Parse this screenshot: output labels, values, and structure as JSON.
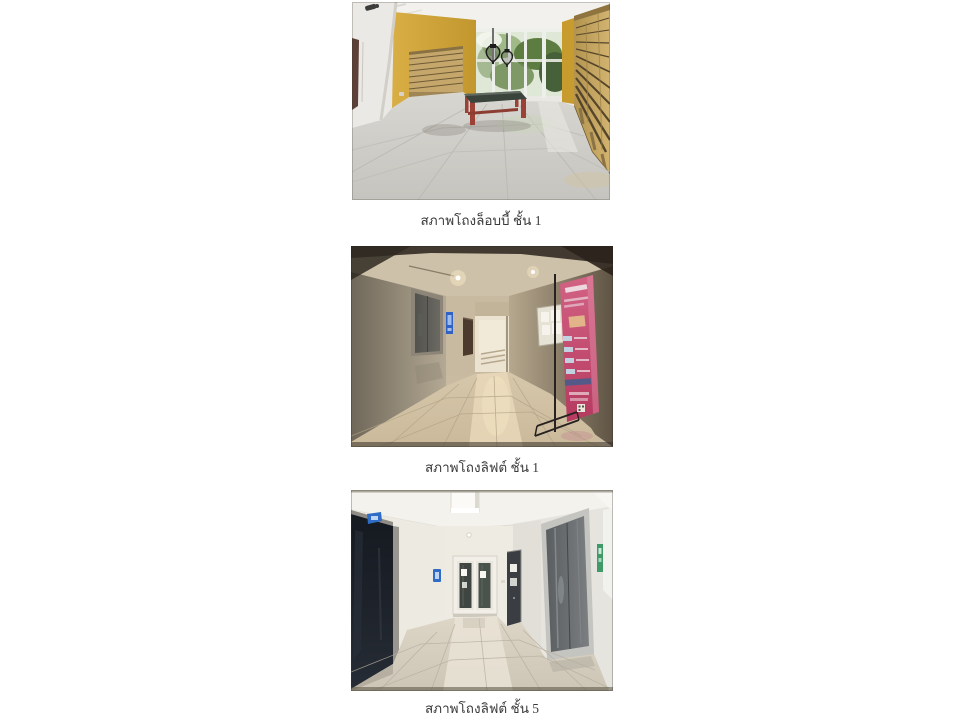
{
  "document": {
    "background_color": "#ffffff",
    "caption_color": "#3a3a3a"
  },
  "figures": [
    {
      "photo_name": "lobby-hall-floor-1-photo",
      "caption": "สภาพโถงล็อบบี้ ชั้น 1",
      "colors": {
        "wall_yellow": "#cda23a",
        "mailbox_tan": "#c6a76b",
        "table_leg_red": "#9c4136",
        "table_top": "#3a443c",
        "foliage_green": "#5d7c42",
        "floor_gray": "#cfcdc8",
        "lamp_black": "#1d1d1d"
      }
    },
    {
      "photo_name": "lift-hall-floor-1-photo",
      "caption": "สภาพโถงลิฟต์ ชั้น 1",
      "colors": {
        "wall_beige": "#b4a994",
        "elevator_gray": "#5c5a54",
        "banner_pink": "#c04468",
        "sign_blue": "#2f62c4",
        "floor_beige": "#d2c2a4",
        "opening_light": "#ebe2cf"
      }
    },
    {
      "photo_name": "lift-hall-floor-5-photo",
      "caption": "สภาพโถงลิฟต์ ชั้น 5",
      "colors": {
        "wall_white": "#eae7e0",
        "dark_door": "#181c23",
        "elevator_gray": "#696d70",
        "sign_blue": "#2f6cc5",
        "sign_green": "#3f9a68",
        "floor_beige": "#d4ccbd"
      }
    }
  ]
}
